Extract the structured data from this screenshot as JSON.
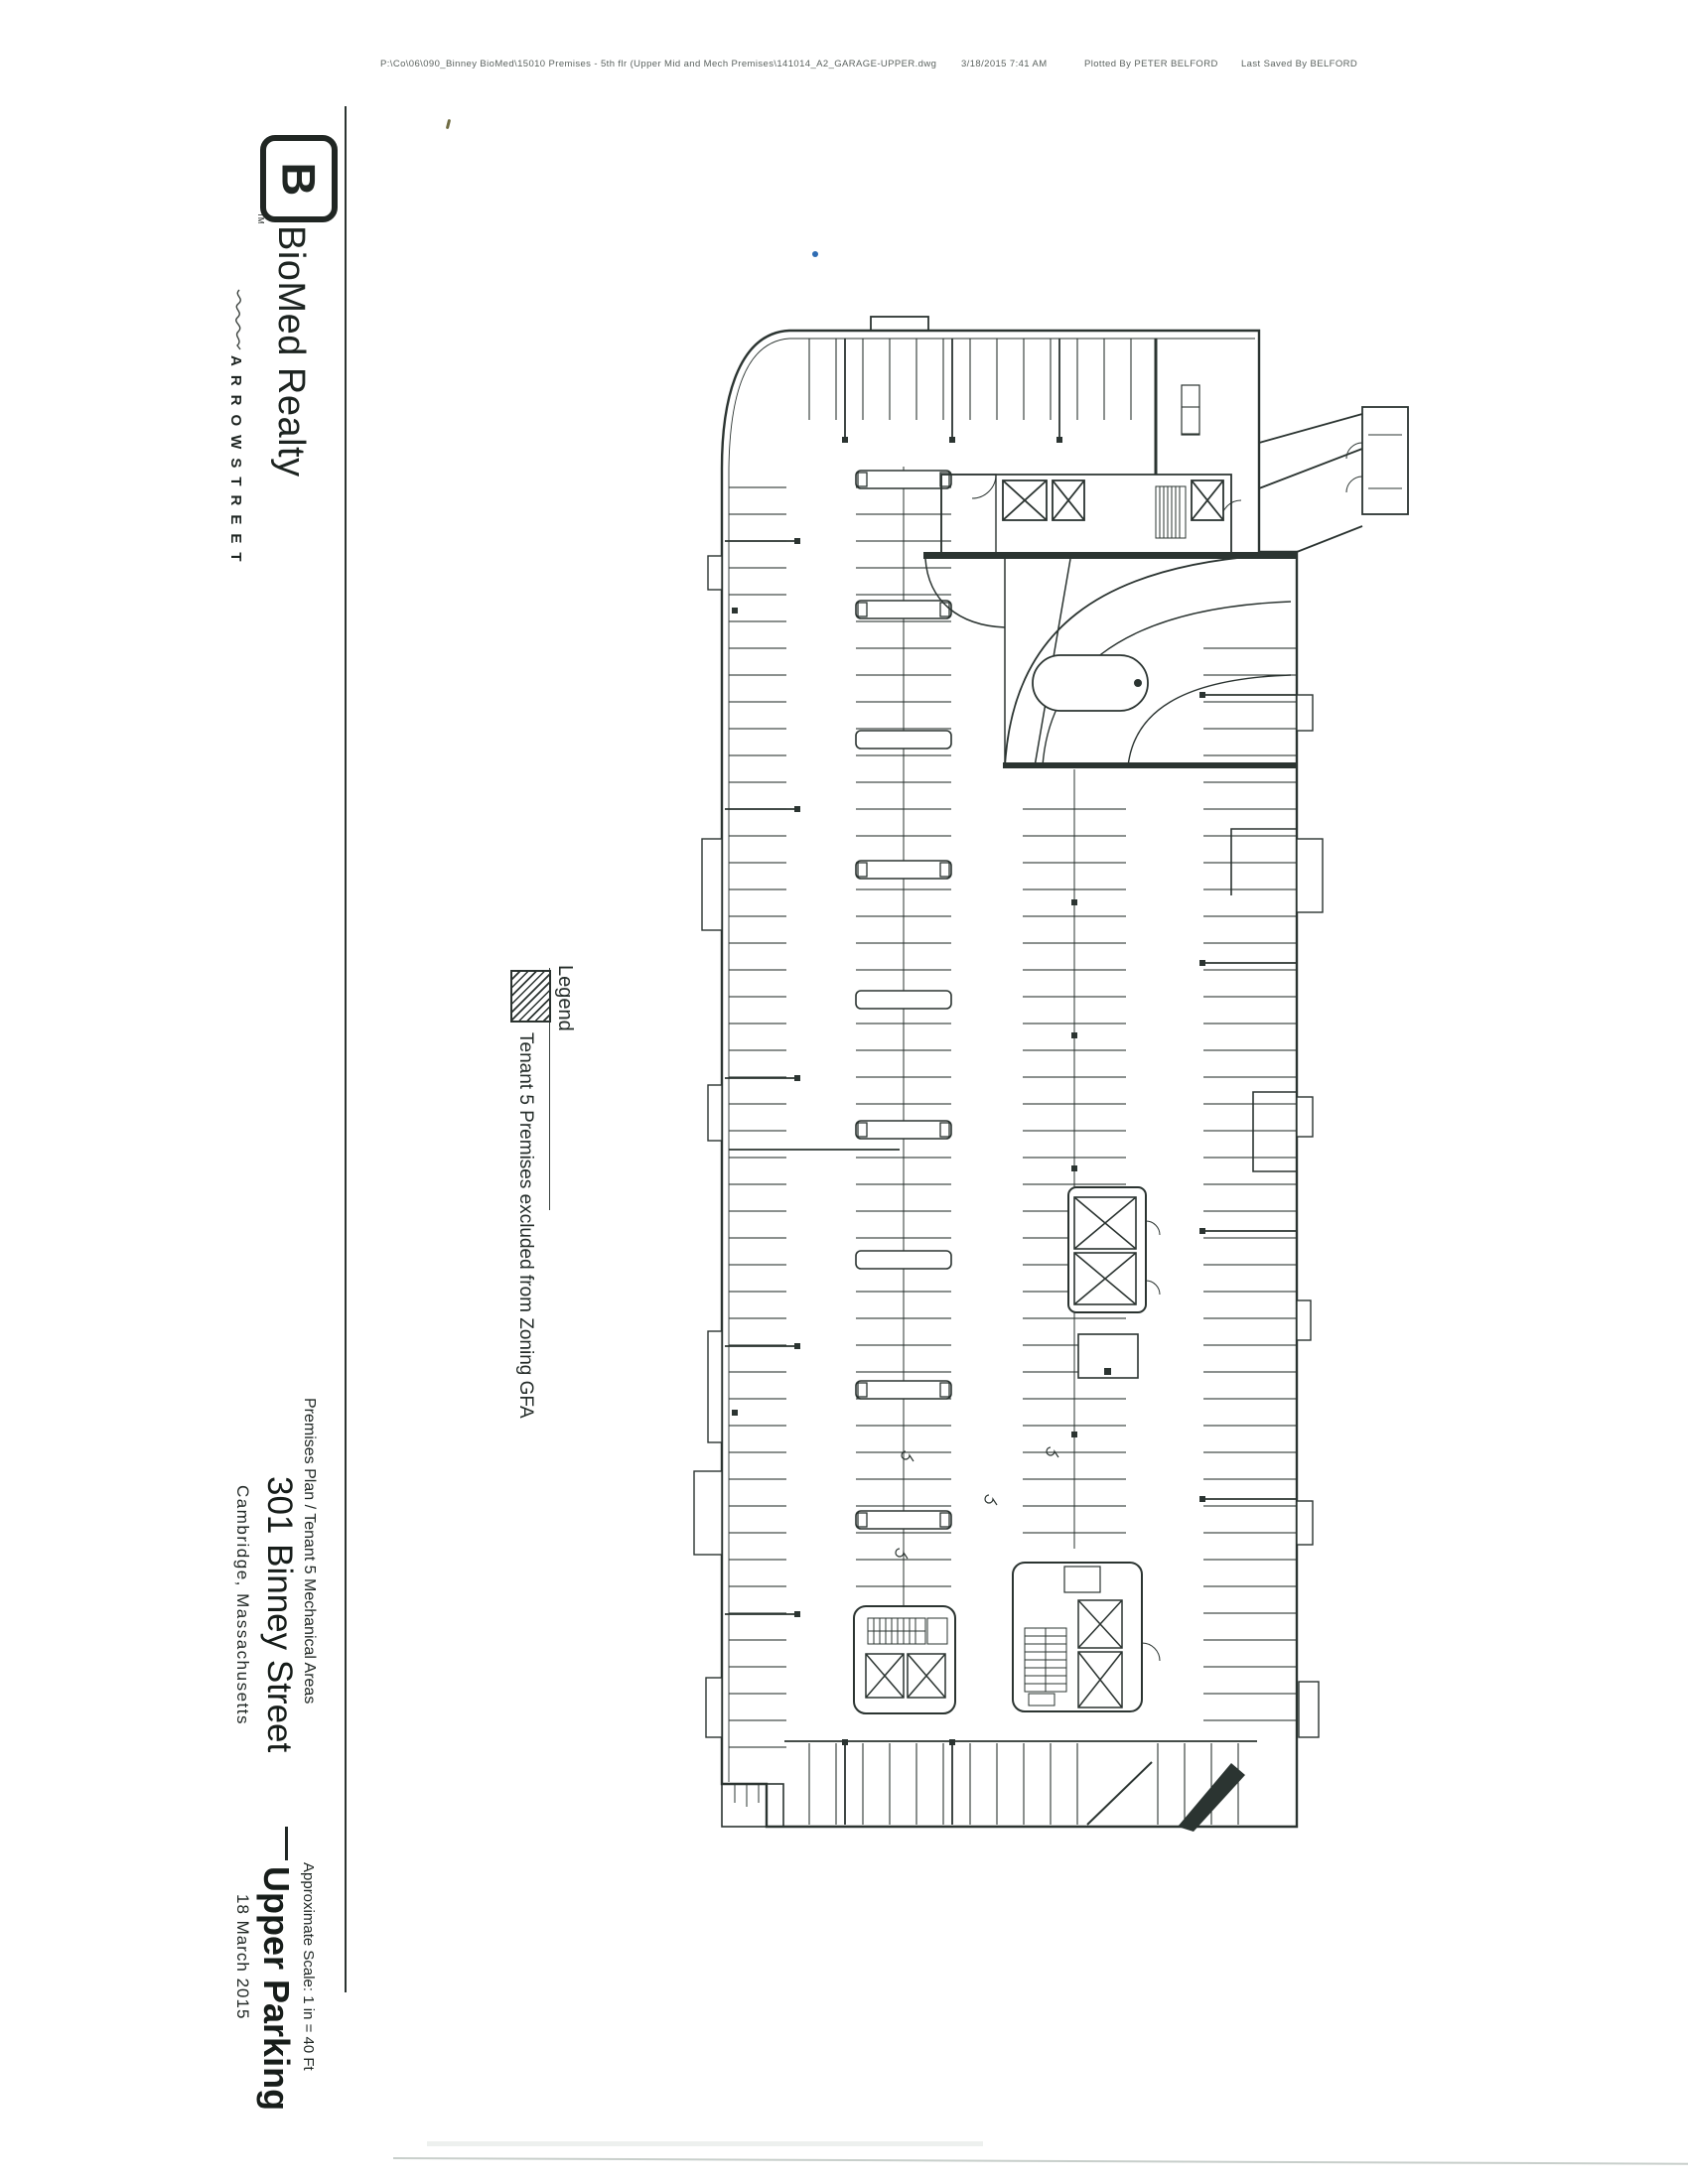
{
  "header_line": {
    "file_path": "P:\\Co\\06\\090_Binney BioMed\\15010 Premises - 5th flr (Upper Mid and Mech Premises\\141014_A2_GARAGE-UPPER.dwg",
    "plot_date": "3/18/2015 7:41 AM",
    "plotted_by": "Plotted By  PETER BELFORD",
    "last_saved_by": "Last Saved By  BELFORD"
  },
  "branding": {
    "logo_monogram": "B",
    "logo_tm": "TM",
    "company": "BioMed Realty",
    "architect": "ARROWSTREET"
  },
  "legend": {
    "title": "Legend",
    "items": [
      {
        "swatch": "diagonal-hatch",
        "label": "Tenant 5 Premises excluded from Zoning GFA"
      }
    ]
  },
  "title_block": {
    "plan_title": "Premises Plan / Tenant 5 Mechanical Areas",
    "address": "301 Binney Street",
    "city": "Cambridge, Massachusetts",
    "scale_note": "Approximate Scale: 1 in = 40 Ft",
    "sheet_name": "Upper Parking",
    "date": "18 March 2015"
  },
  "colors": {
    "ink": "#2b3431",
    "accent_dot": "#2f6cb3",
    "scan_line": "#c8cfcb"
  }
}
